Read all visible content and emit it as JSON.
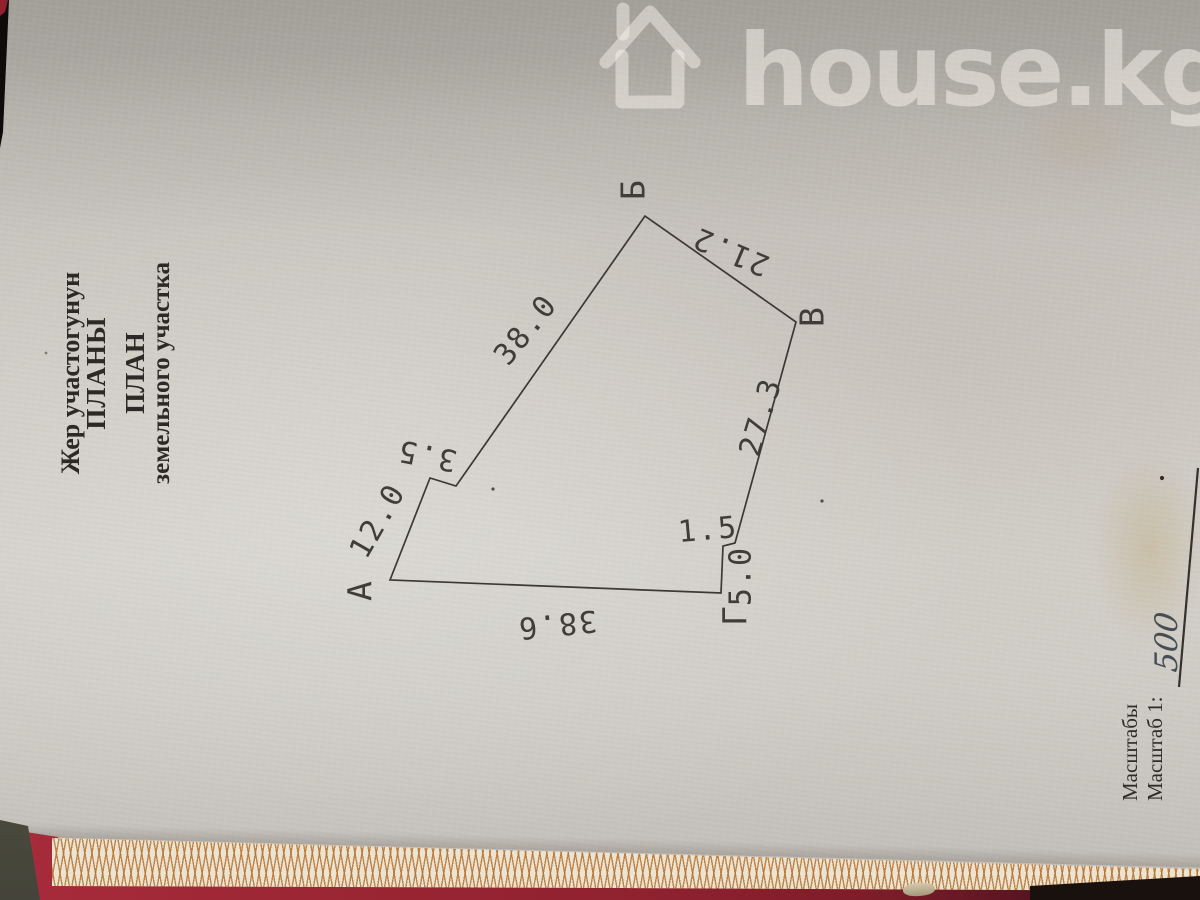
{
  "watermark": {
    "icon": "house-icon",
    "text": "house.kg"
  },
  "title": {
    "line1": "Жер участогунун",
    "line2": "ПЛАНЫ",
    "line3": "ПЛАН",
    "line4": "земельного участка"
  },
  "plan": {
    "vertices": [
      {
        "label": "А"
      },
      {
        "label": "Б"
      },
      {
        "label": "В"
      },
      {
        "label": "Г"
      }
    ],
    "dimensions": [
      {
        "edge": "А-излом",
        "value": "12.0"
      },
      {
        "edge": "излом",
        "value": "3.5"
      },
      {
        "edge": "излом-Б",
        "value": "38.0"
      },
      {
        "edge": "Б-В",
        "value": "21.2"
      },
      {
        "edge": "В-уступ",
        "value": "27.3"
      },
      {
        "edge": "уступ",
        "value": "1.5"
      },
      {
        "edge": "уступ-Г",
        "value": "5.0"
      },
      {
        "edge": "Г-А",
        "value": "38.6"
      }
    ]
  },
  "scale": {
    "line1": "Масштабы",
    "line2": "Масштаб 1:",
    "handwritten_value": "500"
  },
  "colors": {
    "paper": "#cdc9c3",
    "paper_top": "#a6a29c",
    "ink": "#3c3934",
    "watermark": "#c7c4bd",
    "folder_red": "#96222f",
    "edge_pattern_orange": "#b87432",
    "background_dark": "#16100d"
  }
}
